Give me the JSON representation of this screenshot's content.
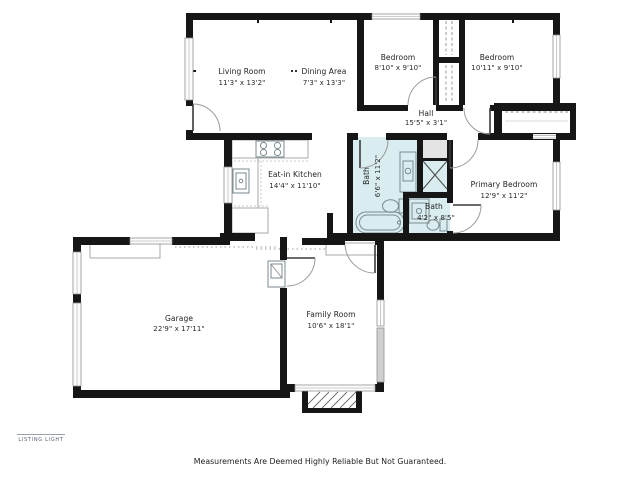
{
  "floor_plan": {
    "rooms": [
      {
        "id": "living-room",
        "name": "Living Room",
        "dims": "11'3\" x 13'2\""
      },
      {
        "id": "dining-area",
        "name": "Dining Area",
        "dims": "7'3\" x 13'3\""
      },
      {
        "id": "bedroom-1",
        "name": "Bedroom",
        "dims": "8'10\" x 9'10\""
      },
      {
        "id": "bedroom-2",
        "name": "Bedroom",
        "dims": "10'11\" x 9'10\""
      },
      {
        "id": "hall",
        "name": "Hall",
        "dims": "15'5\" x 3'1\""
      },
      {
        "id": "eat-in-kitchen",
        "name": "Eat-in Kitchen",
        "dims": "14'4\" x 11'10\""
      },
      {
        "id": "bath-main",
        "name": "Bath",
        "dims": "6'6\" x 11'2\""
      },
      {
        "id": "bath-2",
        "name": "Bath",
        "dims": "4'2\" x 8'5\""
      },
      {
        "id": "primary-bedroom",
        "name": "Primary Bedroom",
        "dims": "12'9\" x 11'2\""
      },
      {
        "id": "garage",
        "name": "Garage",
        "dims": "22'9\" x 17'11\""
      },
      {
        "id": "family-room",
        "name": "Family Room",
        "dims": "10'6\" x 18'1\""
      }
    ],
    "fixtures": {
      "kitchen": [
        "stove-icon",
        "kitchen-sink-icon",
        "counter"
      ],
      "bath_main": [
        "bathtub-icon",
        "toilet-icon",
        "vanity-sink-icon",
        "shower-icon",
        "linen-closet"
      ],
      "bath_2": [
        "vanity-sink-icon",
        "toilet-icon"
      ],
      "garage": [
        "water-heater-icon",
        "workbench"
      ],
      "family_room": [
        "sideboard"
      ],
      "exterior": [
        "porch-steps"
      ]
    },
    "colors": {
      "wall": "#161616",
      "bath_fill": "#d9edf0",
      "closet_fill": "#e4e4e4",
      "background": "#ffffff"
    }
  },
  "watermark": {
    "brand": "LISTING LIGHT"
  },
  "footer": {
    "disclaimer": "Measurements Are Deemed Highly Reliable But Not Guaranteed."
  }
}
